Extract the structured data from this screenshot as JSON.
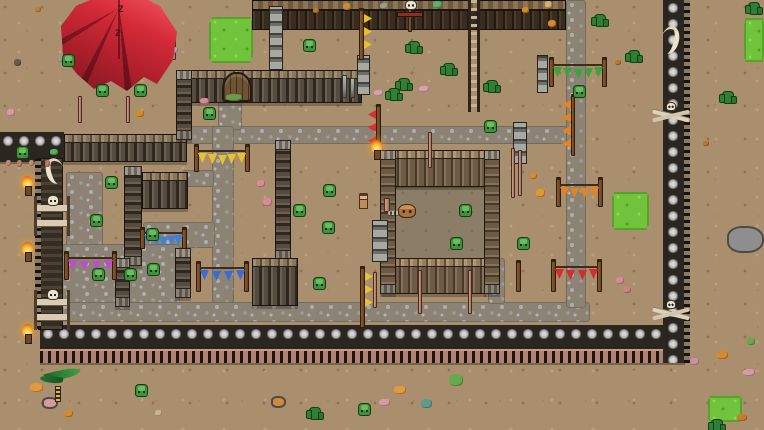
{
  "meta": {
    "scene_description": "top-down pixel-art goblin camp with palisade walls, stone paths, red tent and pennant banners",
    "width": 764,
    "height": 430
  },
  "palette": {
    "ground": "#a98f6e",
    "grass": "#72c33c",
    "cobble": "#9d9d9d",
    "wood_dark": "#4e463c",
    "wood_light": "#a08b6d",
    "stone_wall": "#a3a3a3",
    "tent_red": "#d42a38",
    "torch_flame": "#ffb02e",
    "goblin_green": "#3f9140",
    "bone": "#ece4d0"
  },
  "scene": {
    "tent": {
      "x": 56,
      "y": 0,
      "w": 126,
      "h": 102,
      "mark": "Z",
      "zz": [
        {
          "x": 62,
          "y": 6
        },
        {
          "x": 59,
          "y": 30
        }
      ]
    },
    "grass": [
      {
        "x": 209,
        "y": 17,
        "w": 44,
        "h": 46
      },
      {
        "x": 744,
        "y": 18,
        "w": 20,
        "h": 44
      },
      {
        "x": 612,
        "y": 192,
        "w": 37,
        "h": 38
      },
      {
        "x": 708,
        "y": 396,
        "w": 34,
        "h": 26
      }
    ],
    "paths": [
      {
        "x": 180,
        "y": 126,
        "w": 390,
        "h": 18
      },
      {
        "x": 218,
        "y": 96,
        "w": 24,
        "h": 34
      },
      {
        "x": 212,
        "y": 126,
        "w": 22,
        "h": 180
      },
      {
        "x": 182,
        "y": 170,
        "w": 32,
        "h": 17
      },
      {
        "x": 143,
        "y": 222,
        "w": 72,
        "h": 26
      },
      {
        "x": 66,
        "y": 172,
        "w": 37,
        "h": 76
      },
      {
        "x": 62,
        "y": 244,
        "w": 118,
        "h": 74
      },
      {
        "x": 40,
        "y": 302,
        "w": 550,
        "h": 20
      },
      {
        "x": 566,
        "y": 0,
        "w": 20,
        "h": 308
      },
      {
        "x": 488,
        "y": 258,
        "w": 17,
        "h": 46
      }
    ],
    "pen": {
      "interior": {
        "x": 394,
        "y": 186,
        "w": 92,
        "h": 74
      }
    },
    "walls": [
      {
        "kind": "logtop",
        "x": 252,
        "y": 0,
        "w": 314,
        "h": 30
      },
      {
        "kind": "stoneh",
        "x": 0,
        "y": 132,
        "w": 64,
        "h": 30
      },
      {
        "kind": "palisade",
        "x": 64,
        "y": 134,
        "w": 123,
        "h": 28
      },
      {
        "kind": "palisade",
        "x": 180,
        "y": 70,
        "w": 182,
        "h": 33
      },
      {
        "kind": "palisade",
        "dir": "v",
        "x": 176,
        "y": 70,
        "w": 16,
        "h": 70
      },
      {
        "kind": "palisade",
        "dir": "v",
        "x": 124,
        "y": 166,
        "w": 18,
        "h": 100
      },
      {
        "kind": "palisade",
        "x": 142,
        "y": 172,
        "w": 46,
        "h": 37
      },
      {
        "kind": "palisade",
        "dir": "v",
        "x": 275,
        "y": 140,
        "w": 16,
        "h": 120
      },
      {
        "kind": "palisade",
        "x": 252,
        "y": 258,
        "w": 46,
        "h": 48
      },
      {
        "kind": "palisade",
        "dir": "v",
        "x": 115,
        "y": 258,
        "w": 15,
        "h": 49
      },
      {
        "kind": "palisade",
        "dir": "v",
        "x": 175,
        "y": 248,
        "w": 16,
        "h": 50
      },
      {
        "kind": "penwall",
        "x": 380,
        "y": 150,
        "w": 120,
        "h": 37
      },
      {
        "kind": "penwall",
        "x": 382,
        "y": 258,
        "w": 104,
        "h": 36
      },
      {
        "kind": "penwall",
        "dir": "v",
        "x": 380,
        "y": 150,
        "w": 16,
        "h": 144
      },
      {
        "kind": "penwall",
        "dir": "v",
        "x": 484,
        "y": 150,
        "w": 16,
        "h": 144
      },
      {
        "kind": "stonehT",
        "x": 40,
        "y": 325,
        "w": 645,
        "h": 38
      },
      {
        "kind": "walldark",
        "x": 38,
        "y": 158,
        "w": 25,
        "h": 172
      },
      {
        "kind": "stonev",
        "x": 663,
        "y": 0,
        "w": 27,
        "h": 363
      }
    ],
    "pillars": [
      {
        "x": 269,
        "y": 6,
        "w": 14,
        "h": 64
      },
      {
        "x": 357,
        "y": 55,
        "w": 13,
        "h": 40
      },
      {
        "x": 537,
        "y": 55,
        "w": 11,
        "h": 38
      },
      {
        "x": 513,
        "y": 122,
        "w": 14,
        "h": 42
      },
      {
        "x": 372,
        "y": 220,
        "w": 16,
        "h": 42
      }
    ],
    "posts_gray": [
      {
        "x": 342,
        "y": 75,
        "w": 5,
        "h": 23
      },
      {
        "x": 350,
        "y": 78,
        "w": 5,
        "h": 20
      }
    ],
    "ladders": [
      {
        "x": 468,
        "y": 0,
        "w": 12,
        "h": 112
      }
    ],
    "gates": [
      {
        "x": 222,
        "y": 72,
        "w": 30,
        "h": 30
      }
    ],
    "bone_gates": [
      {
        "x": 34,
        "y": 196,
        "w": 36,
        "h": 40
      },
      {
        "x": 34,
        "y": 290,
        "w": 36,
        "h": 40
      }
    ],
    "totems": [
      {
        "x": 652,
        "y": 100,
        "w": 38,
        "h": 30
      },
      {
        "x": 652,
        "y": 298,
        "w": 38,
        "h": 32
      }
    ],
    "horns": [
      {
        "x": 46,
        "y": 158,
        "w": 18,
        "h": 26,
        "flip": false
      },
      {
        "x": 661,
        "y": 26,
        "w": 18,
        "h": 28,
        "flip": true
      }
    ],
    "banners": [
      {
        "label": "yellow-bunting",
        "color": "#e8c22e",
        "x1": 194,
        "x2": 245,
        "poleY": 144,
        "poleH": 28,
        "flagY": 152,
        "n": 5
      },
      {
        "label": "teal-bunting",
        "color": "#3f7fd4",
        "x1": 140,
        "x2": 182,
        "poleY": 227,
        "poleH": 22,
        "flagY": 234,
        "n": 5
      },
      {
        "label": "blue-bunting",
        "color": "#3a6bd8",
        "x1": 196,
        "x2": 244,
        "poleY": 261,
        "poleH": 31,
        "flagY": 269,
        "n": 4
      },
      {
        "label": "purple-bunting",
        "color": "#c04ad0",
        "x1": 64,
        "x2": 112,
        "poleY": 251,
        "poleH": 29,
        "flagY": 259,
        "n": 4
      },
      {
        "label": "green-bunting",
        "color": "#3da23c",
        "x1": 549,
        "x2": 602,
        "poleY": 57,
        "poleH": 30,
        "flagY": 66,
        "n": 5
      },
      {
        "label": "orange-bunting",
        "color": "#e8821e",
        "x1": 556,
        "x2": 598,
        "poleY": 177,
        "poleH": 30,
        "flagY": 186,
        "n": 4
      },
      {
        "label": "red-bunting",
        "color": "#d82a2e",
        "x1": 551,
        "x2": 597,
        "poleY": 259,
        "poleH": 33,
        "flagY": 268,
        "n": 4
      }
    ],
    "bunting_v": [
      {
        "label": "orange-vertical-bunting",
        "color": "#e8821e",
        "poleX": 571,
        "poleY": 94,
        "poleH": 62,
        "flagX": 562,
        "flagY": 100,
        "n": 4
      }
    ],
    "flagpoles": [
      {
        "label": "yellow-flagpole-bottom",
        "color": "#e8c22e",
        "x": 360,
        "y": 266,
        "h": 62,
        "n": 3,
        "dir": "r"
      },
      {
        "label": "yellow-flagpole-top",
        "color": "#e8c22e",
        "x": 359,
        "y": 8,
        "h": 52,
        "n": 3,
        "dir": "r"
      },
      {
        "label": "red-flagpole",
        "color": "#d8302a",
        "x": 376,
        "y": 104,
        "h": 40,
        "n": 3,
        "dir": "l"
      }
    ],
    "lone_poles": [
      {
        "x": 516,
        "y": 260,
        "w": 5,
        "h": 32
      }
    ],
    "pink_poles": [
      {
        "x": 78,
        "y": 96,
        "w": 4,
        "h": 27
      },
      {
        "x": 126,
        "y": 96,
        "w": 4,
        "h": 27
      },
      {
        "x": 511,
        "y": 148,
        "w": 4,
        "h": 50
      },
      {
        "x": 518,
        "y": 150,
        "w": 4,
        "h": 46
      },
      {
        "x": 373,
        "y": 272,
        "w": 4,
        "h": 36
      },
      {
        "x": 418,
        "y": 270,
        "w": 4,
        "h": 44
      },
      {
        "x": 468,
        "y": 270,
        "w": 4,
        "h": 44
      },
      {
        "x": 79,
        "y": 4,
        "w": 5,
        "h": 36
      },
      {
        "x": 172,
        "y": 40,
        "w": 4,
        "h": 20
      },
      {
        "x": 428,
        "y": 132,
        "w": 4,
        "h": 36
      }
    ],
    "torches": [
      {
        "x": 21,
        "y": 176
      },
      {
        "x": 21,
        "y": 242
      },
      {
        "x": 21,
        "y": 324
      },
      {
        "x": 370,
        "y": 140
      }
    ],
    "scarecrows": [
      {
        "x": 397,
        "y": 0
      }
    ],
    "rocks": [
      {
        "x": 727,
        "y": 226,
        "w": 37,
        "h": 27,
        "c": "#8e8e8e",
        "ore": true
      },
      {
        "x": 42,
        "y": 397,
        "w": 16,
        "h": 12,
        "c": "#d49aa2",
        "ore": false
      },
      {
        "x": 271,
        "y": 396,
        "w": 15,
        "h": 12,
        "c": "#cd8a3e",
        "ore": false
      }
    ],
    "plants": [
      {
        "type": "agave",
        "x": 40,
        "y": 366,
        "w": 42,
        "h": 22
      },
      {
        "type": "stem",
        "x": 55,
        "y": 386,
        "w": 6,
        "h": 16
      }
    ],
    "cacti": [
      {
        "x": 408,
        "y": 41
      },
      {
        "x": 443,
        "y": 63
      },
      {
        "x": 398,
        "y": 78
      },
      {
        "x": 486,
        "y": 80
      },
      {
        "x": 388,
        "y": 88
      },
      {
        "x": 628,
        "y": 50
      },
      {
        "x": 594,
        "y": 14
      },
      {
        "x": 722,
        "y": 91
      },
      {
        "x": 748,
        "y": 2
      },
      {
        "x": 309,
        "y": 407
      },
      {
        "x": 711,
        "y": 419
      }
    ],
    "goblins": [
      {
        "x": 62,
        "y": 54
      },
      {
        "x": 96,
        "y": 84
      },
      {
        "x": 134,
        "y": 84
      },
      {
        "x": 16,
        "y": 146
      },
      {
        "x": 203,
        "y": 107
      },
      {
        "x": 303,
        "y": 39
      },
      {
        "x": 484,
        "y": 120
      },
      {
        "x": 573,
        "y": 85
      },
      {
        "x": 105,
        "y": 176
      },
      {
        "x": 90,
        "y": 214
      },
      {
        "x": 146,
        "y": 228
      },
      {
        "x": 92,
        "y": 268
      },
      {
        "x": 124,
        "y": 268
      },
      {
        "x": 147,
        "y": 263
      },
      {
        "x": 323,
        "y": 184
      },
      {
        "x": 293,
        "y": 204
      },
      {
        "x": 322,
        "y": 221
      },
      {
        "x": 313,
        "y": 277
      },
      {
        "x": 459,
        "y": 204
      },
      {
        "x": 450,
        "y": 237
      },
      {
        "x": 517,
        "y": 237
      },
      {
        "x": 135,
        "y": 384
      },
      {
        "x": 358,
        "y": 403
      }
    ],
    "characters": {
      "human": {
        "x": 357,
        "y": 193,
        "w": 11,
        "h": 15
      },
      "creature": {
        "x": 398,
        "y": 204,
        "w": 18,
        "h": 14
      },
      "chain": {
        "x": 388,
        "y": 211,
        "w": 11,
        "h": 4
      },
      "post": {
        "x": 384,
        "y": 198,
        "w": 6,
        "h": 14
      }
    },
    "decor": [
      {
        "x": 257,
        "y": 180,
        "w": 8,
        "h": 7,
        "c": "#d98a9a"
      },
      {
        "x": 263,
        "y": 198,
        "w": 9,
        "h": 8,
        "c": "#d98a9a"
      },
      {
        "x": 200,
        "y": 98,
        "w": 9,
        "h": 6,
        "c": "#d98a9a"
      },
      {
        "x": 616,
        "y": 277,
        "w": 8,
        "h": 7,
        "c": "#d98a9a"
      },
      {
        "x": 623,
        "y": 287,
        "w": 8,
        "h": 6,
        "c": "#cf7f90"
      },
      {
        "x": 7,
        "y": 109,
        "w": 8,
        "h": 7,
        "c": "#d59aa5"
      },
      {
        "x": 374,
        "y": 90,
        "w": 9,
        "h": 6,
        "c": "#d8a0ae"
      },
      {
        "x": 419,
        "y": 86,
        "w": 10,
        "h": 6,
        "c": "#d8a0ae"
      },
      {
        "x": 743,
        "y": 369,
        "w": 12,
        "h": 7,
        "c": "#d59aa5"
      },
      {
        "x": 379,
        "y": 399,
        "w": 11,
        "h": 7,
        "c": "#d59aa5"
      },
      {
        "x": 690,
        "y": 358,
        "w": 9,
        "h": 7,
        "c": "#cf8f9f"
      },
      {
        "x": 530,
        "y": 173,
        "w": 7,
        "h": 6,
        "c": "#d8892b"
      },
      {
        "x": 536,
        "y": 189,
        "w": 9,
        "h": 8,
        "c": "#e09a2e"
      },
      {
        "x": 548,
        "y": 20,
        "w": 8,
        "h": 7,
        "c": "#d8892b"
      },
      {
        "x": 522,
        "y": 7,
        "w": 7,
        "h": 6,
        "c": "#d8892b"
      },
      {
        "x": 343,
        "y": 3,
        "w": 8,
        "h": 7,
        "c": "#cc8a2e"
      },
      {
        "x": 380,
        "y": 3,
        "w": 8,
        "h": 6,
        "c": "#9a9a8e"
      },
      {
        "x": 433,
        "y": 1,
        "w": 9,
        "h": 7,
        "c": "#5fae6e"
      },
      {
        "x": 545,
        "y": 1,
        "w": 7,
        "h": 7,
        "c": "#d8b06a"
      },
      {
        "x": 170,
        "y": 47,
        "w": 8,
        "h": 6,
        "c": "#a8a8a0"
      },
      {
        "x": 58,
        "y": 56,
        "w": 6,
        "h": 6,
        "c": "#9a9a94"
      },
      {
        "x": 14,
        "y": 59,
        "w": 7,
        "h": 7,
        "c": "#6a5a48"
      },
      {
        "x": 35,
        "y": 7,
        "w": 6,
        "h": 5,
        "c": "#c08030"
      },
      {
        "x": 64,
        "y": 410,
        "w": 9,
        "h": 7,
        "c": "#d8892b"
      },
      {
        "x": 30,
        "y": 383,
        "w": 13,
        "h": 9,
        "c": "#e09a40"
      },
      {
        "x": 394,
        "y": 386,
        "w": 12,
        "h": 8,
        "c": "#e09a40"
      },
      {
        "x": 136,
        "y": 110,
        "w": 8,
        "h": 7,
        "c": "#d8892b"
      },
      {
        "x": 449,
        "y": 374,
        "w": 14,
        "h": 12,
        "c": "#6aa84f"
      },
      {
        "x": 421,
        "y": 399,
        "w": 11,
        "h": 9,
        "c": "#5f9a8a"
      },
      {
        "x": 717,
        "y": 351,
        "w": 11,
        "h": 8,
        "c": "#d8892b"
      },
      {
        "x": 737,
        "y": 414,
        "w": 10,
        "h": 7,
        "c": "#cc7a2e"
      },
      {
        "x": 747,
        "y": 338,
        "w": 8,
        "h": 7,
        "c": "#6aa84f"
      },
      {
        "x": 50,
        "y": 149,
        "w": 8,
        "h": 6,
        "c": "#5fae5e"
      },
      {
        "x": 226,
        "y": 94,
        "w": 16,
        "h": 7,
        "c": "#6a9a4a"
      },
      {
        "x": 6,
        "y": 160,
        "w": 5,
        "h": 6,
        "c": "#c08878"
      },
      {
        "x": 17,
        "y": 160,
        "w": 5,
        "h": 7,
        "c": "#b87a6a"
      },
      {
        "x": 29,
        "y": 160,
        "w": 5,
        "h": 6,
        "c": "#c08878"
      },
      {
        "x": 45,
        "y": 160,
        "w": 5,
        "h": 7,
        "c": "#b87a6a"
      },
      {
        "x": 703,
        "y": 141,
        "w": 6,
        "h": 5,
        "c": "#b87828"
      },
      {
        "x": 615,
        "y": 60,
        "w": 6,
        "h": 5,
        "c": "#b87828"
      },
      {
        "x": 313,
        "y": 8,
        "w": 6,
        "h": 5,
        "c": "#b87828"
      },
      {
        "x": 155,
        "y": 410,
        "w": 7,
        "h": 6,
        "c": "#c9b690"
      }
    ]
  }
}
